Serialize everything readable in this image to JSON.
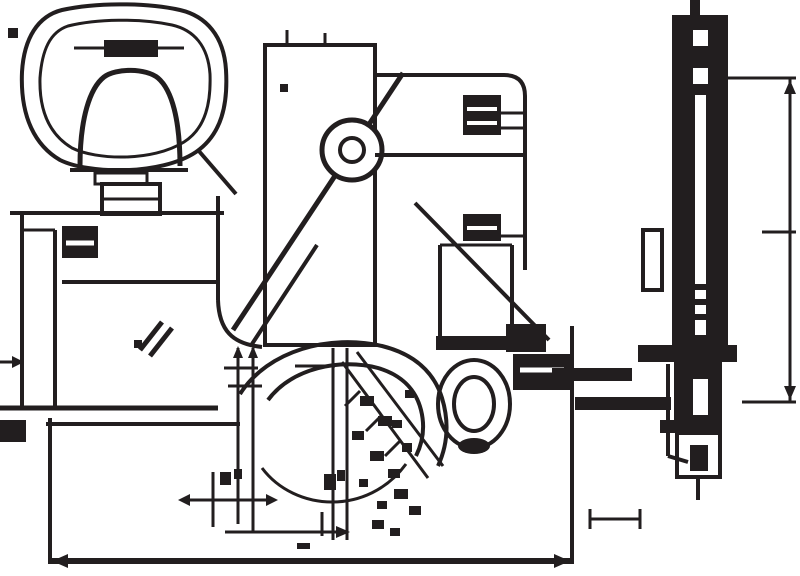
{
  "canvas": {
    "width": 800,
    "height": 576,
    "background": "#ffffff",
    "ink": "#221e1f"
  },
  "drawing": {
    "description": "technical-drawing-of-single-lever-faucet",
    "groups": [
      {
        "name": "handle-plan-view",
        "shapes": [
          [
            "path",
            "M 62 10 C 38 16 24 38 22 72 C 20 118 36 146 60 160 C 88 174 160 176 196 152 C 222 134 228 104 226 70 C 224 36 206 16 180 10 C 144 2 94 3 62 10 Z",
            4
          ],
          [
            "path",
            "M 68 26 C 50 32 42 50 40 78 C 39 114 52 136 72 148 C 96 160 152 162 184 142 C 206 128 211 102 210 74 C 208 46 194 30 172 25 C 140 18 96 19 68 26 Z",
            3
          ],
          [
            "line",
            74,
            48,
            184,
            48,
            3
          ],
          [
            "rect",
            104,
            40,
            54,
            17
          ],
          [
            "path",
            "M 80 166 C 80 118 90 88 104 77 C 116 68 146 68 158 78 C 172 90 180 120 180 166",
            5
          ],
          [
            "line",
            70,
            170,
            188,
            170,
            4
          ],
          [
            "srect",
            95,
            173,
            52,
            11,
            3
          ],
          [
            "srect",
            102,
            184,
            58,
            30,
            4
          ],
          [
            "line",
            102,
            199,
            160,
            199,
            3
          ],
          [
            "line",
            198,
            150,
            236,
            194,
            4
          ]
        ]
      },
      {
        "name": "base-front-view",
        "shapes": [
          [
            "line",
            10,
            213,
            224,
            213,
            4
          ],
          [
            "line",
            22,
            213,
            22,
            410,
            4
          ],
          [
            "line",
            55,
            230,
            55,
            410,
            4
          ],
          [
            "line",
            22,
            230,
            55,
            230,
            3
          ],
          [
            "rect",
            62,
            226,
            36,
            32
          ],
          [
            "wline",
            66,
            243,
            94,
            243,
            5
          ],
          [
            "line",
            62,
            282,
            218,
            282,
            4
          ],
          [
            "line",
            218,
            196,
            218,
            300,
            4
          ],
          [
            "path",
            "M 218 300 C 219 330 232 344 262 347",
            4
          ],
          [
            "line",
            0,
            362,
            20,
            362,
            3
          ],
          [
            "poly",
            "24,362 12,356 12,368"
          ],
          [
            "line",
            0,
            408,
            218,
            408,
            5
          ],
          [
            "line",
            46,
            424,
            240,
            424,
            4
          ],
          [
            "rect",
            0,
            420,
            26,
            22
          ],
          [
            "line",
            140,
            350,
            162,
            322,
            5
          ],
          [
            "line",
            150,
            356,
            172,
            328,
            5
          ],
          [
            "rect",
            134,
            340,
            8,
            8
          ]
        ]
      },
      {
        "name": "column-front-view",
        "shapes": [
          [
            "srect",
            265,
            45,
            110,
            300,
            4
          ],
          [
            "line",
            287,
            30,
            287,
            45,
            3
          ],
          [
            "line",
            325,
            33,
            325,
            45,
            3
          ],
          [
            "rect",
            280,
            84,
            8,
            8
          ]
        ]
      },
      {
        "name": "lever-lines",
        "shapes": [
          [
            "line",
            233,
            330,
            403,
            73,
            5
          ],
          [
            "line",
            252,
            344,
            317,
            245,
            4
          ],
          [
            "line",
            415,
            203,
            549,
            340,
            4
          ]
        ]
      },
      {
        "name": "pivot-circle",
        "shapes": [
          [
            "circle",
            352,
            150,
            30,
            "white",
            5
          ],
          [
            "circle",
            352,
            150,
            12,
            "none",
            4
          ]
        ]
      },
      {
        "name": "spout-front-block",
        "shapes": [
          [
            "path",
            "M 375 75 L 504 75 Q 525 75 525 96 L 525 270",
            4
          ],
          [
            "line",
            375,
            155,
            525,
            155,
            4
          ],
          [
            "rect",
            463,
            95,
            38,
            40
          ],
          [
            "wline",
            467,
            109,
            497,
            109,
            4
          ],
          [
            "wline",
            467,
            123,
            497,
            123,
            4
          ],
          [
            "line",
            501,
            113,
            525,
            113,
            3
          ],
          [
            "line",
            501,
            128,
            525,
            128,
            3
          ],
          [
            "rect",
            463,
            214,
            38,
            27
          ],
          [
            "wline",
            467,
            228,
            497,
            228,
            4
          ],
          [
            "line",
            501,
            236,
            525,
            236,
            3
          ],
          [
            "line",
            440,
            245,
            440,
            338,
            4
          ],
          [
            "line",
            512,
            245,
            512,
            338,
            4
          ],
          [
            "line",
            440,
            245,
            512,
            245,
            3
          ],
          [
            "rect",
            436,
            336,
            80,
            14
          ]
        ]
      },
      {
        "name": "aerator-rings",
        "shapes": [
          [
            "ellipse",
            474,
            404,
            36,
            44,
            4
          ],
          [
            "ellipse",
            474,
            404,
            20,
            27,
            4
          ],
          [
            "fellipse",
            474,
            446,
            16,
            8
          ]
        ]
      },
      {
        "name": "swivel-arcs",
        "shapes": [
          [
            "path",
            "M 240 394 C 268 350 330 334 382 346 C 414 354 434 372 442 398 C 449 421 448 444 438 466",
            4
          ],
          [
            "path",
            "M 268 400 C 292 368 340 358 378 368 C 402 375 416 390 421 410 C 425 426 423 442 416 456",
            4
          ],
          [
            "path",
            "M 262 468 C 295 512 368 516 406 464",
            3
          ]
        ]
      },
      {
        "name": "left-dimension-verticals",
        "shapes": [
          [
            "line",
            238,
            348,
            238,
            524,
            3
          ],
          [
            "line",
            253,
            348,
            253,
            532,
            3
          ],
          [
            "poly",
            "238,346 233,358 243,358"
          ],
          [
            "poly",
            "253,346 248,358 258,358"
          ],
          [
            "line",
            224,
            368,
            258,
            368,
            3
          ],
          [
            "line",
            228,
            386,
            262,
            386,
            3
          ],
          [
            "line",
            333,
            348,
            333,
            540,
            3
          ],
          [
            "line",
            347,
            348,
            347,
            540,
            3
          ],
          [
            "line",
            295,
            366,
            335,
            366,
            3
          ]
        ]
      },
      {
        "name": "bottom-dimension-cross",
        "shapes": [
          [
            "line",
            182,
            500,
            274,
            500,
            3
          ],
          [
            "poly",
            "178,500 190,494 190,506"
          ],
          [
            "poly",
            "278,500 266,494 266,506"
          ],
          [
            "line",
            213,
            472,
            213,
            527,
            3
          ],
          [
            "rect",
            220,
            472,
            11,
            13
          ],
          [
            "rect",
            234,
            469,
            8,
            10
          ]
        ]
      },
      {
        "name": "bottom-leader",
        "shapes": [
          [
            "line",
            225,
            532,
            342,
            532,
            3
          ],
          [
            "poly",
            "350,532 336,526 336,538"
          ],
          [
            "line",
            322,
            512,
            322,
            536,
            3
          ],
          [
            "rect",
            324,
            474,
            12,
            16
          ],
          [
            "rect",
            337,
            470,
            8,
            11
          ],
          [
            "rect",
            297,
            543,
            13,
            6
          ]
        ]
      },
      {
        "name": "diagonal-leader-annotations",
        "shapes": [
          [
            "line",
            342,
            362,
            428,
            478,
            3
          ],
          [
            "line",
            357,
            352,
            443,
            466,
            3
          ],
          [
            "line",
            345,
            406,
            360,
            391,
            3
          ],
          [
            "line",
            366,
            431,
            381,
            416,
            3
          ],
          [
            "line",
            385,
            456,
            400,
            441,
            3
          ],
          [
            "rect",
            360,
            396,
            14,
            10
          ],
          [
            "rect",
            378,
            416,
            14,
            10
          ],
          [
            "rect",
            352,
            431,
            12,
            9
          ],
          [
            "rect",
            370,
            451,
            14,
            10
          ],
          [
            "rect",
            388,
            469,
            12,
            9
          ],
          [
            "rect",
            402,
            443,
            10,
            9
          ],
          [
            "rect",
            394,
            489,
            14,
            10
          ],
          [
            "rect",
            377,
            501,
            10,
            8
          ],
          [
            "rect",
            409,
            506,
            12,
            9
          ],
          [
            "rect",
            359,
            479,
            9,
            8
          ],
          [
            "rect",
            392,
            420,
            10,
            8
          ],
          [
            "rect",
            405,
            390,
            9,
            8
          ],
          [
            "rect",
            372,
            520,
            12,
            9
          ],
          [
            "rect",
            390,
            528,
            10,
            8
          ]
        ]
      },
      {
        "name": "overall-width-dimension",
        "shapes": [
          [
            "line",
            50,
            418,
            50,
            564,
            4
          ],
          [
            "line",
            572,
            326,
            572,
            564,
            4
          ],
          [
            "line",
            50,
            561,
            572,
            561,
            6
          ],
          [
            "poly",
            "52,561 68,554 68,568"
          ],
          [
            "poly",
            "570,561 554,554 554,568"
          ]
        ]
      },
      {
        "name": "hose-connector",
        "shapes": [
          [
            "rect",
            506,
            324,
            40,
            28
          ],
          [
            "rect",
            513,
            354,
            60,
            36
          ],
          [
            "wline",
            520,
            370,
            564,
            370,
            5
          ],
          [
            "rect",
            552,
            368,
            80,
            13
          ],
          [
            "rect",
            575,
            397,
            96,
            13
          ],
          [
            "line",
            668,
            364,
            668,
            456,
            4
          ],
          [
            "line",
            668,
            456,
            688,
            462,
            4
          ]
        ]
      },
      {
        "name": "side-view",
        "shapes": [
          [
            "rect",
            690,
            0,
            10,
            16
          ],
          [
            "rect",
            672,
            15,
            56,
            335
          ],
          [
            "wrect",
            693,
            30,
            15,
            16
          ],
          [
            "wrect",
            693,
            68,
            15,
            16
          ],
          [
            "wrect",
            695,
            95,
            11,
            240
          ],
          [
            "rect",
            695,
            284,
            11,
            6
          ],
          [
            "rect",
            695,
            299,
            11,
            6
          ],
          [
            "rect",
            695,
            314,
            11,
            6
          ],
          [
            "srect",
            643,
            230,
            19,
            60,
            4
          ],
          [
            "rect",
            638,
            345,
            99,
            17
          ],
          [
            "rect",
            674,
            362,
            48,
            58
          ],
          [
            "wrect",
            693,
            379,
            15,
            36
          ],
          [
            "rect",
            660,
            420,
            62,
            13
          ],
          [
            "srect",
            677,
            433,
            43,
            44,
            4
          ],
          [
            "rect",
            690,
            445,
            18,
            26
          ],
          [
            "line",
            698,
            477,
            698,
            500,
            4
          ]
        ]
      },
      {
        "name": "side-height-dimension",
        "shapes": [
          [
            "line",
            728,
            78,
            796,
            78,
            3
          ],
          [
            "line",
            790,
            78,
            790,
            402,
            3
          ],
          [
            "poly",
            "790,80 784,94 796,94"
          ],
          [
            "poly",
            "790,400 784,386 796,386"
          ],
          [
            "line",
            762,
            232,
            796,
            232,
            3
          ],
          [
            "line",
            742,
            402,
            796,
            402,
            3
          ]
        ]
      },
      {
        "name": "bottom-right-leader",
        "shapes": [
          [
            "line",
            590,
            519,
            640,
            519,
            3
          ],
          [
            "line",
            590,
            509,
            590,
            529,
            3
          ],
          [
            "line",
            640,
            509,
            640,
            529,
            3
          ]
        ]
      },
      {
        "name": "misc-marks",
        "shapes": [
          [
            "rect",
            8,
            28,
            10,
            10
          ]
        ]
      }
    ]
  }
}
